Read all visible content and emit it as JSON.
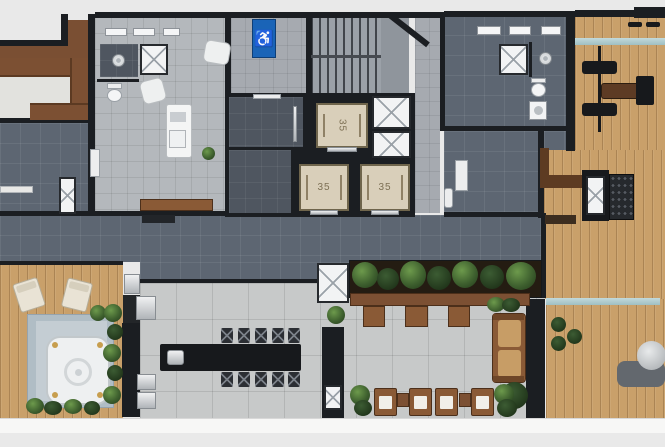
{
  "scene": {
    "type": "residential-amenities-floor-plan",
    "elevators": {
      "cab1_label": "35",
      "cab2_label": "35",
      "cab3_label": "35"
    },
    "accessibility_sign": {
      "symbol": "♿",
      "color": "#1a64b7"
    },
    "palette": {
      "background": "#e9e9e9",
      "wall": "#1b1e22",
      "dark_tile": "#5d6672",
      "light_tile": "#b4b8bc",
      "large_tile": "#c7c9c9",
      "wood_deck": "#c9a06a",
      "wood_furniture": "#7c5033",
      "elevator_cab": "#d9cfba",
      "plant_green": "#3f612f",
      "glass": "#b7d2d4",
      "fixture_white": "#f2f3f4",
      "spa_stone": "#b0bdc5"
    }
  }
}
